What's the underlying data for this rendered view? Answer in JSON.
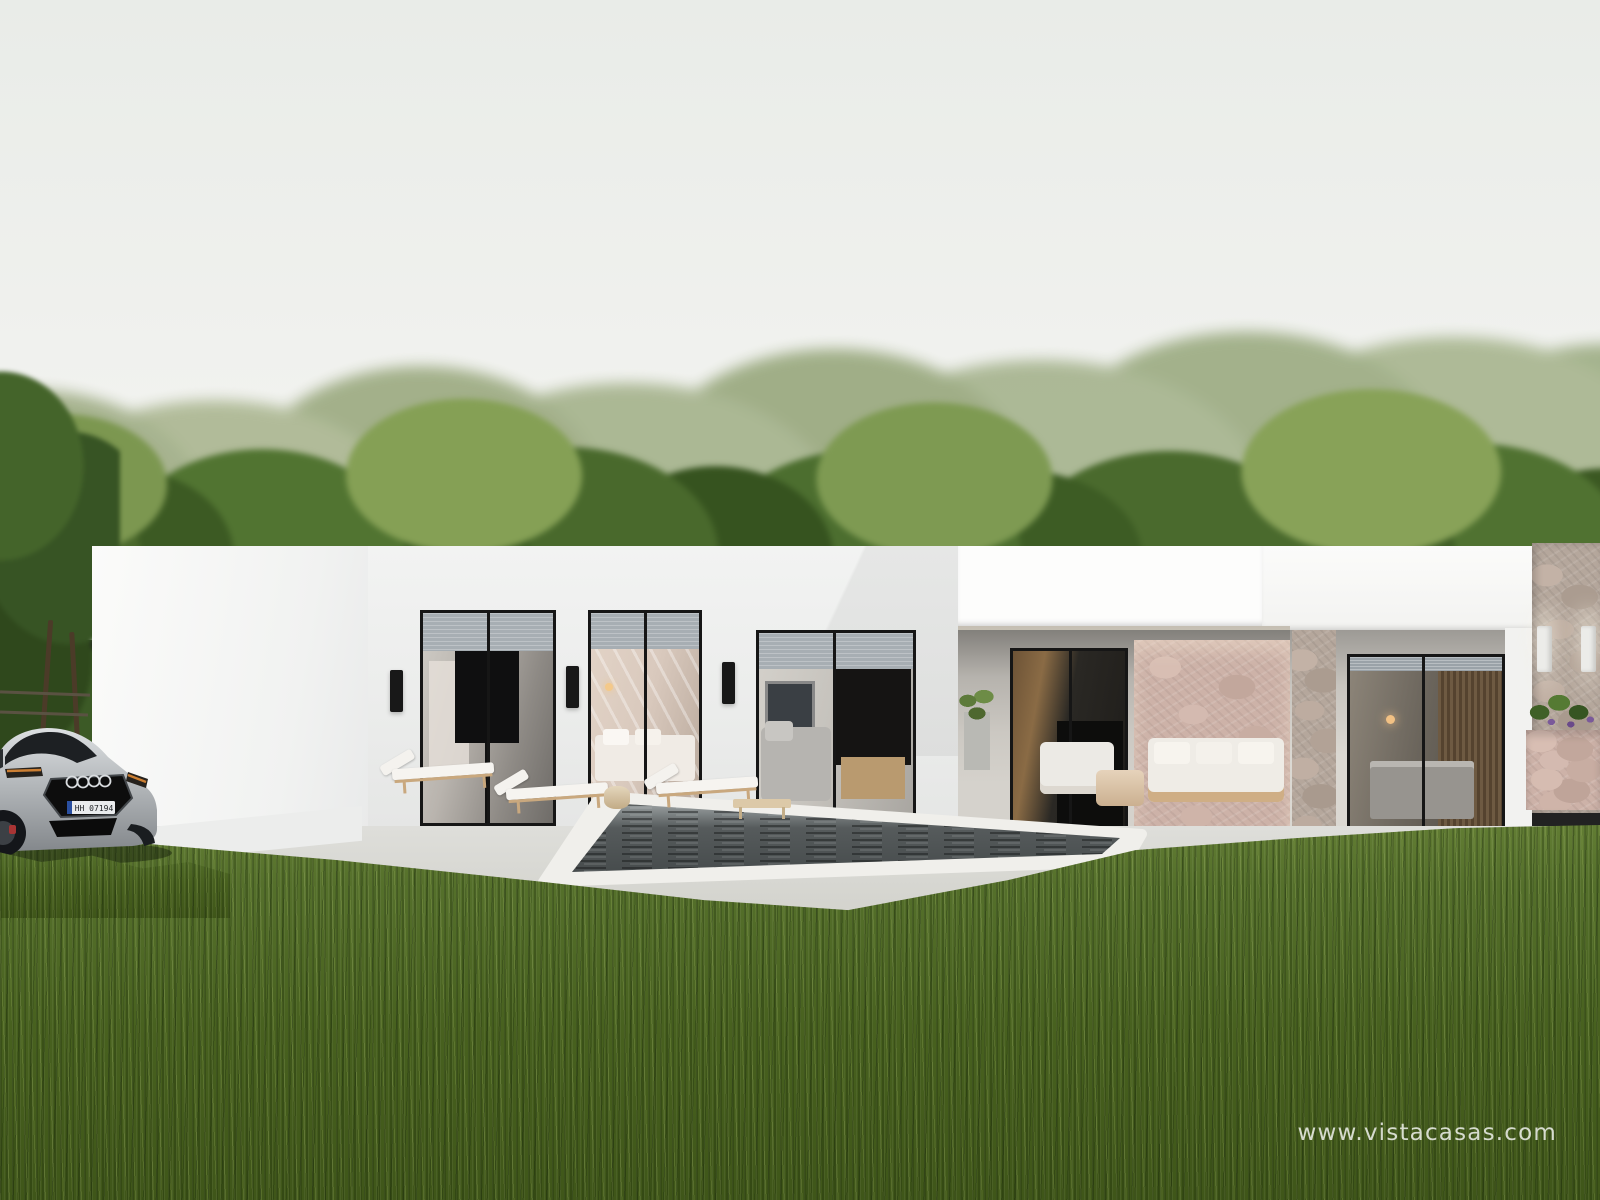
{
  "watermark": {
    "text": "www.vistacasas.com"
  },
  "car": {
    "license_plate": "HH 07194",
    "brand_mark": "audi-rings-icon",
    "description": "silver sedan parked on lawn at left"
  },
  "scene_elements": [
    "overcast-sky",
    "blurred-tree-line",
    "dark-green-trees",
    "modern-white-flat-roof-villa",
    "roller-shutter-windows",
    "sliding-glass-doors",
    "black-wall-sconces",
    "white-wall-sconces",
    "stone-accent-wall",
    "stone-clad-column",
    "covered-terrace",
    "outdoor-sofa",
    "outdoor-armchair",
    "round-coffee-table",
    "sun-loungers",
    "wooden-bench",
    "potted-plant",
    "flower-planter",
    "swimming-pool",
    "white-pool-coping",
    "concrete-terrace",
    "silver-car",
    "lawn-foreground"
  ],
  "colors": {
    "sky-top": "#e9ece8",
    "sky-bottom": "#f6f6f3",
    "far-trees": "#a7b38e",
    "trees": "#47662b",
    "house-white": "#f2f3f2",
    "fascia-white": "#fdfdfc",
    "shutter": "#a7aeb3",
    "frame-black": "#161616",
    "stone": "#cdb2a8",
    "stone-gray": "#b5a79c",
    "terrace": "#d3d3cd",
    "path-white": "#ecedec",
    "pool-coping": "#f0efeb",
    "pool-water": "#4e5354",
    "grass-light": "#647f35",
    "grass-dark": "#3f5619",
    "car-silver": "#b4b8bb",
    "sconce-black": "#181818",
    "sconce-white": "#ecece9",
    "amber": "#cc7f33",
    "plate-blue": "#2a4fa0",
    "wood": "#c9a87e"
  }
}
